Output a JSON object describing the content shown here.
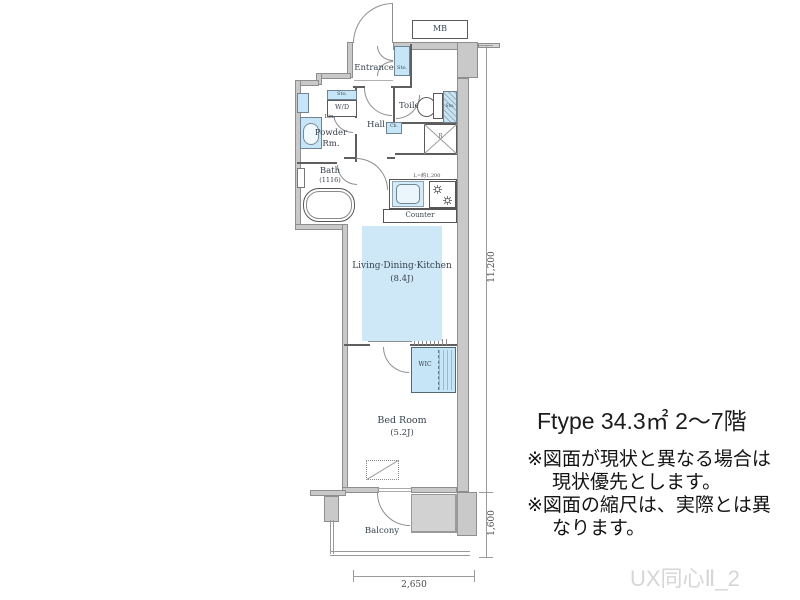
{
  "plan": {
    "mb": "MB",
    "entrance": {
      "label": "Entrance",
      "sto": "Sto."
    },
    "hall": "Hall",
    "toilet": {
      "label": "Toilet",
      "sto": "Sto."
    },
    "wd": {
      "sto": "Sto.",
      "label": "W/D"
    },
    "lin": "Lin.",
    "powder": [
      "Powder",
      "Rm."
    ],
    "bath": [
      "Bath",
      "(1116)"
    ],
    "cb": "Cb.",
    "fridge": "R",
    "kitchen": {
      "length": "L=約1,200",
      "counter": "Counter"
    },
    "ldk": [
      "Living·Dining·Kitchen",
      "(8.4J)"
    ],
    "wic": "WIC",
    "bedroom": [
      "Bed Room",
      "(5.2J)"
    ],
    "balcony": "Balcony"
  },
  "dimensions": {
    "main_height": "11,200",
    "balcony_height": "1,600",
    "bottom_width": "2,650"
  },
  "info": {
    "title": "Ftype 34.3㎡ 2〜7階",
    "notes": [
      "※図面が現状と異なる場合は",
      "現状優先とします。",
      "※図面の縮尺は、実際とは異",
      "なります。"
    ],
    "watermark": "UX同心Ⅱ_2"
  },
  "colors": {
    "water_blue": "#c6e5f6",
    "ldk_blue": "#cfe8f8",
    "wall_gray": "#c9c9c9",
    "watermark_gray": "#d6d6d6"
  }
}
